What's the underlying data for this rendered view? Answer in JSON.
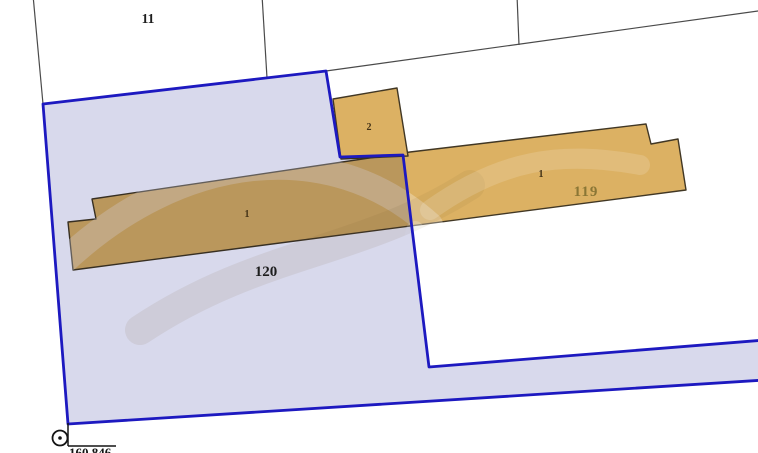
{
  "map": {
    "labels": {
      "parcel_11": "11",
      "parcel_120": "120",
      "parcel_119": "119",
      "building_left_number": "1",
      "building_top_number": "2",
      "building_right_number": "1",
      "survey_point_value": "160.846"
    },
    "colors": {
      "background": "#ffffff",
      "boundary_line": "#4a4a4a",
      "selected_parcel_stroke": "#1d19c0",
      "selected_parcel_fill": "#d8d9ec",
      "building_fill": "#dcb163",
      "building_stroke": "#413724",
      "parcel_label_text": "#1d1d1d",
      "parcel_119_label_text": "#8a7635",
      "building_number_text": "#433217",
      "survey_text": "#141414"
    }
  }
}
